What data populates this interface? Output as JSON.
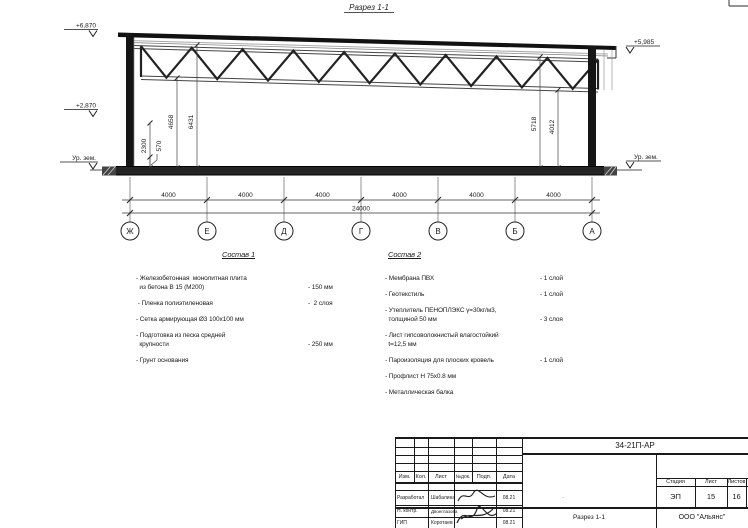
{
  "page": {
    "section_title": "Разрез 1-1"
  },
  "drawing": {
    "elevations": {
      "left_top": "+6,870",
      "left_mid": "+2,870",
      "left_ground": "Ур. зем.",
      "right_top": "+5,985",
      "right_ground": "Ур. зем."
    },
    "vdims": [
      "2300",
      "570",
      "4658",
      "6431",
      "5718",
      "4012"
    ],
    "spans": [
      "4000",
      "4000",
      "4000",
      "4000",
      "4000",
      "4000"
    ],
    "total": "24000",
    "axes": [
      "Ж",
      "Е",
      "Д",
      "Г",
      "В",
      "Б",
      "А"
    ]
  },
  "compositions": [
    {
      "title": "Состав 1",
      "items": [
        {
          "text": "- Железобетонная  монолитная плита\n  из бетона В 15 (М200)",
          "value": "- 150 мм"
        },
        {
          "text": " - Пленка полиэтиленовая",
          "value": "-  2 слоя"
        },
        {
          "text": "- Сетка армирующая Ø3 100х100 мм",
          "value": ""
        },
        {
          "text": "- Подготовка из песка средней\n  крупности",
          "value": "- 250 мм"
        },
        {
          "text": "- Грунт основания",
          "value": ""
        }
      ]
    },
    {
      "title": "Состав 2",
      "items": [
        {
          "text": "- Мембрана ПВХ",
          "value": "- 1 слой"
        },
        {
          "text": "- Геотекстиль",
          "value": "- 1 слой"
        },
        {
          "text": "- Утеплитель ПЕНОПЛЭКС γ=30кг/м3,\n  толщиной 50 мм",
          "value": "- 3 слоя"
        },
        {
          "text": "- Лист гипсоволокнистый влагостойкий\n  t=12,5 мм",
          "value": ""
        },
        {
          "text": "- Пароизоляция для плоских кровель",
          "value": "- 1 слой"
        },
        {
          "text": "- Профлист Н 75х0.8 мм",
          "value": ""
        },
        {
          "text": "- Металлическая балка",
          "value": ""
        }
      ]
    }
  ],
  "titleblock": {
    "code": "34-21П-АР",
    "header_cols": [
      "Изм.",
      "Кол.",
      "Лист",
      "№док.",
      "Подп.",
      "Дата"
    ],
    "rows": [
      {
        "role": "Разработал",
        "name": "Шабалина",
        "date": "08.21"
      },
      {
        "role": "Н. контр.",
        "name": "Двоеглазова",
        "date": "08.21"
      },
      {
        "role": "ГИП",
        "name": "Коротаев",
        "date": "08.21"
      }
    ],
    "stage_header": [
      "Стадия",
      "Лист",
      "Листов"
    ],
    "stage_values": [
      "ЭП",
      "15",
      "16"
    ],
    "drawing_name": "Разрез 1-1",
    "company": "ООО \"Альянс\"",
    "field_mark": "."
  }
}
